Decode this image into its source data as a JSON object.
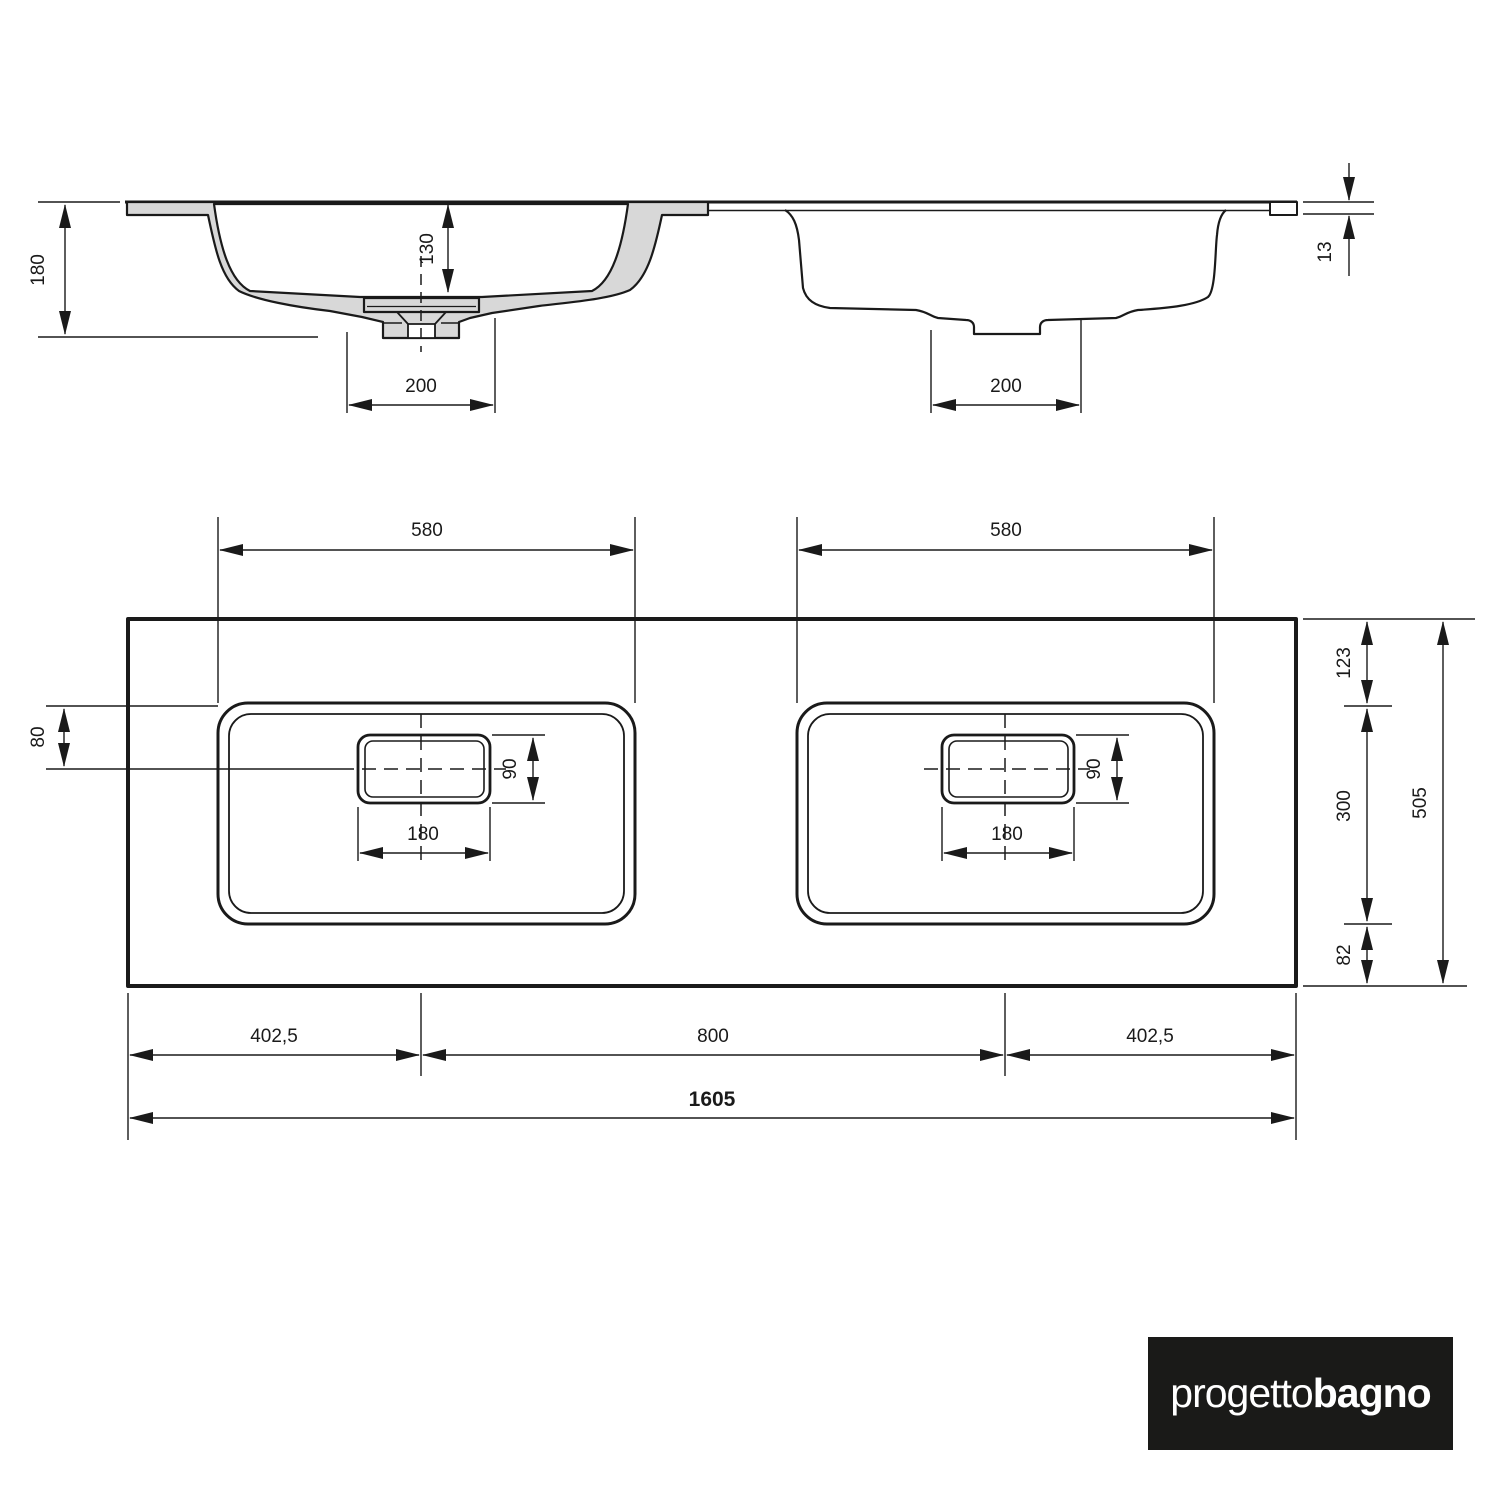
{
  "section": {
    "dim_total_depth": "180",
    "dim_bowl_depth": "130",
    "dim_drain_width_left": "200",
    "dim_drain_width_right": "200",
    "dim_top_thickness": "13"
  },
  "plan": {
    "dim_bowl_width_left": "580",
    "dim_bowl_width_right": "580",
    "dim_edge_to_drain_axis": "80",
    "dim_drain_height_left": "90",
    "dim_drain_height_right": "90",
    "dim_drain_width_left": "180",
    "dim_drain_width_right": "180",
    "dim_margin_top": "123",
    "dim_bowl_depth": "300",
    "dim_margin_bottom": "82",
    "dim_total_depth": "505",
    "dim_margin_left": "402,5",
    "dim_drain_spacing": "800",
    "dim_margin_right": "402,5",
    "dim_total_width": "1605"
  },
  "logo": {
    "brand_regular": "progetto",
    "brand_bold": "bagno"
  },
  "colors": {
    "line": "#1a1a1a",
    "section_fill": "#d8d8d8",
    "logo_background": "#1a1a18",
    "logo_text": "#ffffff"
  }
}
